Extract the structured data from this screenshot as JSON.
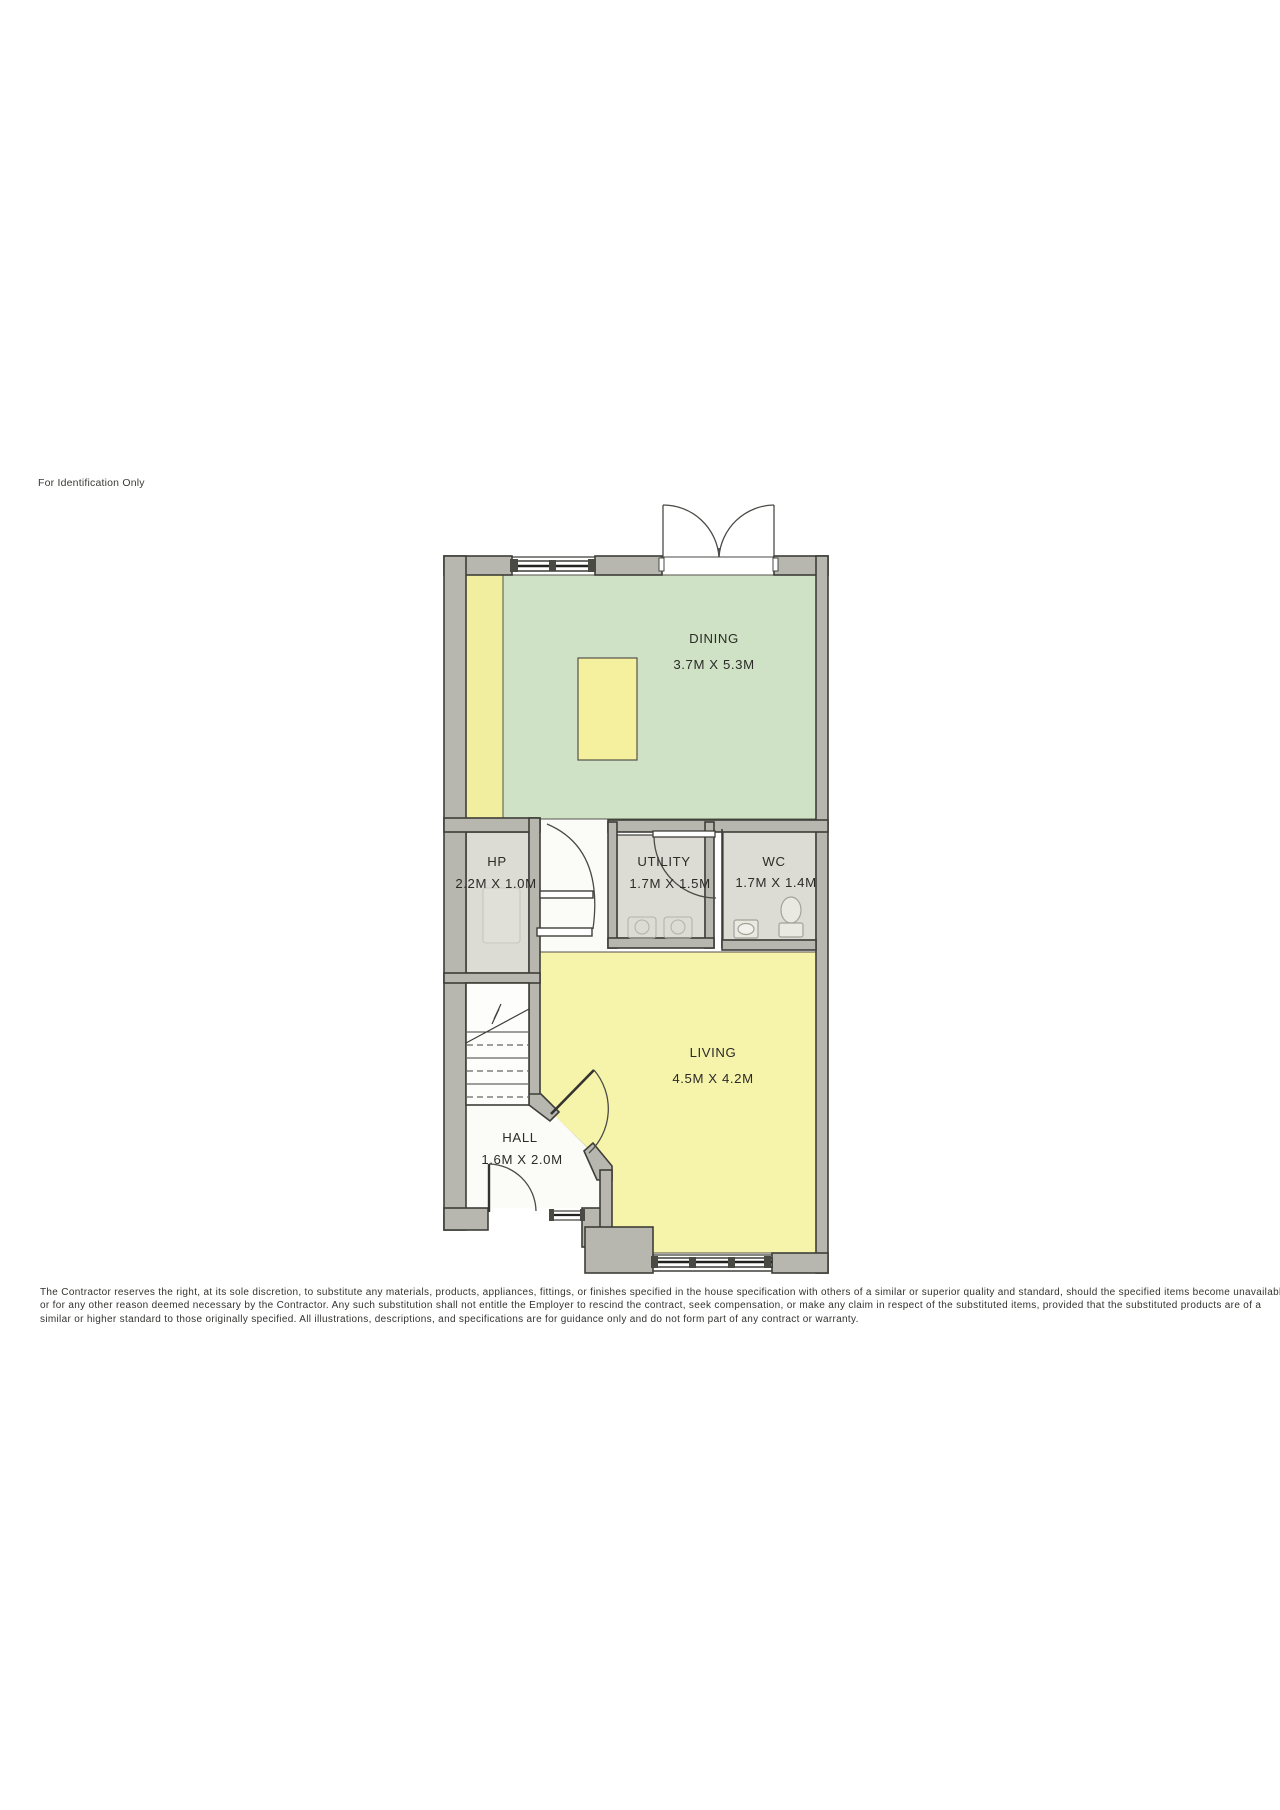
{
  "page": {
    "identification_note": "For Identification Only",
    "disclaimer": {
      "lines": [
        "The Contractor reserves the right, at its sole discretion, to substitute any materials, products, appliances, fittings, or finishes specified in the house specification with others of a similar or superior quality and standard, should the specified items become unavailable",
        "or for any other reason deemed necessary by the Contractor. Any such substitution shall not entitle the Employer to rescind the contract, seek compensation, or make any claim in respect of the substituted items, provided that the substituted products are of a",
        "similar or higher standard to those originally specified. All illustrations, descriptions, and specifications are for guidance only and do not form part of any contract or warranty."
      ]
    }
  },
  "floorplan": {
    "rooms": [
      {
        "name": "DINING",
        "dimensions": "3.7M X 5.3M"
      },
      {
        "name": "HP",
        "dimensions": "2.2M X 1.0M"
      },
      {
        "name": "UTILITY",
        "dimensions": "1.7M X 1.5M"
      },
      {
        "name": "WC",
        "dimensions": "1.7M X 1.4M"
      },
      {
        "name": "LIVING",
        "dimensions": "4.5M X 4.2M"
      },
      {
        "name": "HALL",
        "dimensions": "1.6M X 2.0M"
      }
    ],
    "colors": {
      "wall_fill": "#b7b7af",
      "wall_line": "#3e3e38",
      "dining_floor": "#cfe2c5",
      "living_floor": "#f6f3ab",
      "kitchen_strip": "#f2eea0",
      "table": "#f4f09e",
      "utility_floor": "#dcdcd5",
      "hall_floor": "#fbfbf8"
    }
  }
}
